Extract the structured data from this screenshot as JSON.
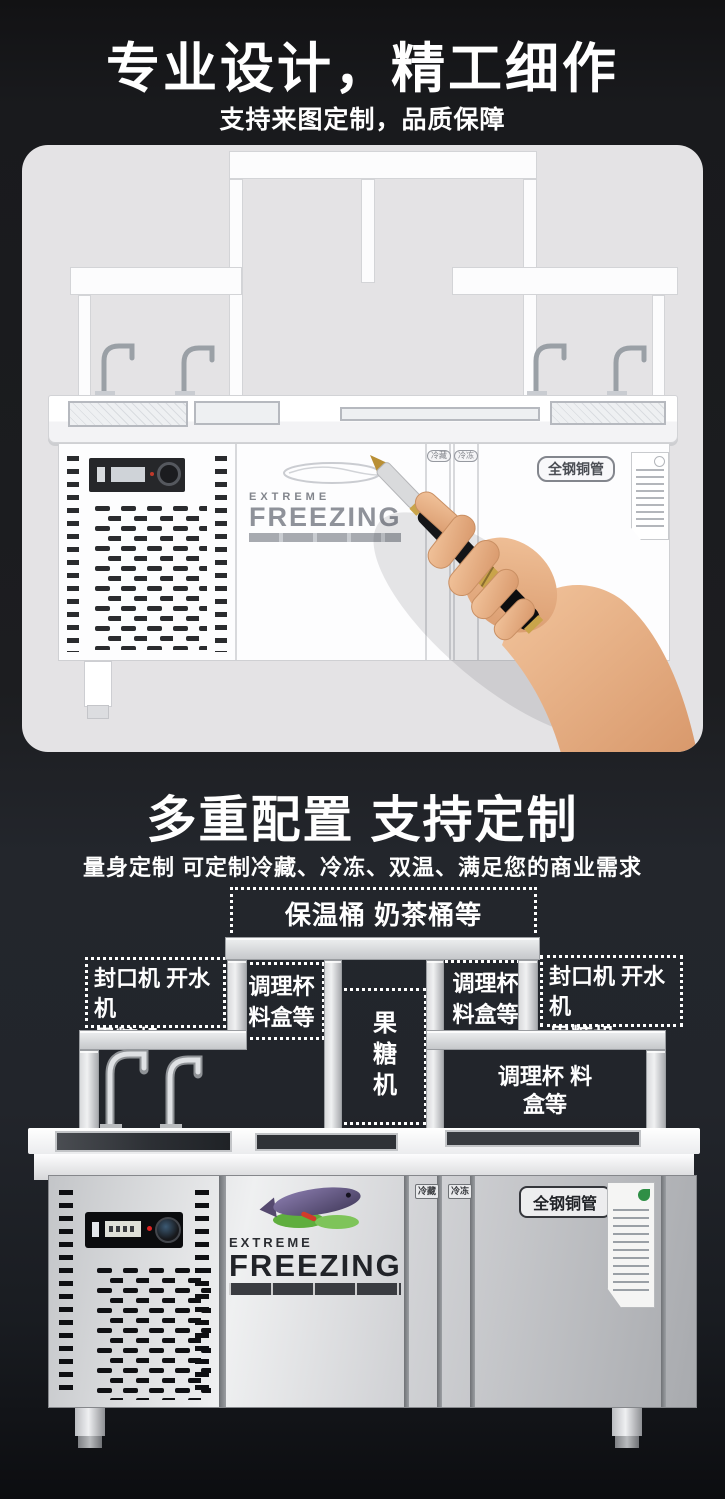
{
  "header1": {
    "title": "专业设计，精工细作",
    "subtitle": "支持来图定制，品质保障"
  },
  "header2": {
    "title": "多重配置 支持定制",
    "subtitle": "量身定制 可定制冷藏、冷冻、双温、满足您的商业需求"
  },
  "callouts": {
    "top": "保温桶 奶茶桶等",
    "left": {
      "line1": "封口机 开水机",
      "line2": "果糖机"
    },
    "mid_left": {
      "line1": "调理杯",
      "line2": "料盒等"
    },
    "center_vertical": "果糖机",
    "mid_right": {
      "line1": "调理杯",
      "line2": "料盒等"
    },
    "right": {
      "line1": "封口机 开水机",
      "line2": "果糖机"
    },
    "under_shelf": {
      "line1": "调理杯",
      "line2": "料盒等"
    }
  },
  "sketch_unit": {
    "brand_top": "EXTREME",
    "brand_main": "FREEZING",
    "tag_cold": "冷藏",
    "tag_freeze": "冷冻",
    "label_pipe": "全钢铜管"
  },
  "photo_unit": {
    "brand_top": "EXTREME",
    "brand_main": "FREEZING",
    "tag_cold": "冷藏",
    "tag_freeze": "冷冻",
    "label_pipe": "全钢铜管"
  },
  "colors": {
    "page_bg_top": "#141417",
    "page_bg_mid": "#23262b",
    "card_bg": "#e4e3e5",
    "callout_white": "#ffffff",
    "steel_light": "#eceded",
    "steel_dark": "#a7a9ad",
    "gold": "#c9a44a"
  }
}
